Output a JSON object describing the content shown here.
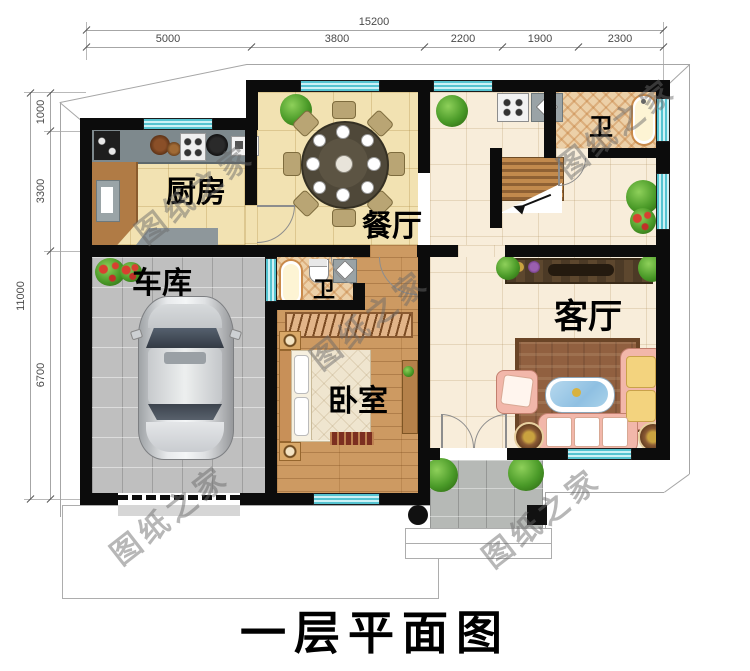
{
  "title": "一层平面图",
  "watermark_text": "图纸之家",
  "rooms": {
    "kitchen": "厨房",
    "dining": "餐厅",
    "bath_top": "卫",
    "bath_mid": "卫",
    "garage": "车库",
    "bedroom": "卧室",
    "living": "客厅"
  },
  "dimensions": {
    "top_total": "15200",
    "top_segments": [
      "5000",
      "3800",
      "2200",
      "1900",
      "2300"
    ],
    "left_total": "11000",
    "left_segments": [
      "1000",
      "3300",
      "6700"
    ]
  }
}
